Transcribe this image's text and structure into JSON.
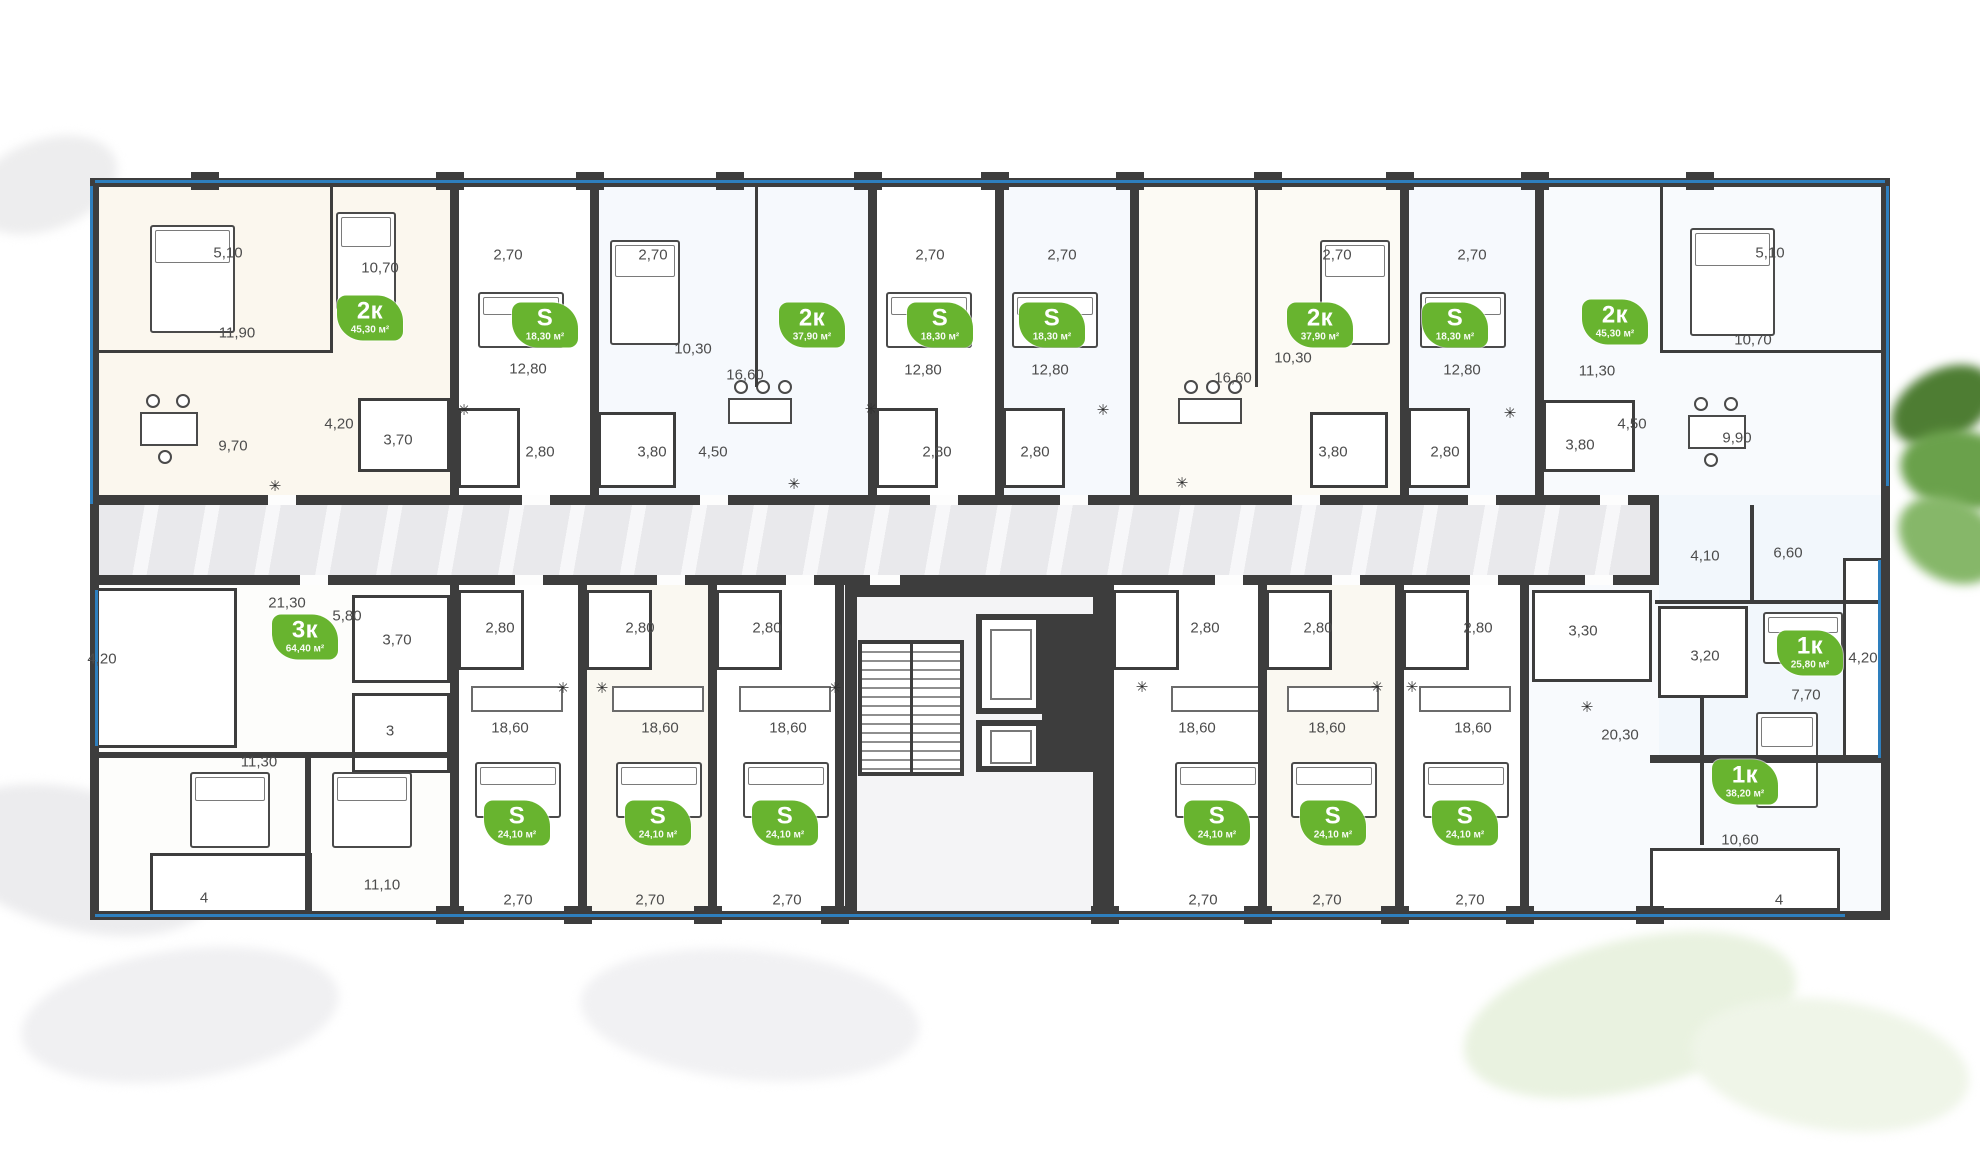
{
  "meta": {
    "description": "Residential building floor plan with apartment type badges and room dimensions"
  },
  "colors": {
    "badge_green": "#68b42f",
    "wall_dark": "#3d3d3d",
    "glazing_blue": "#2e7fbe",
    "corridor_gray": "#eaeaec",
    "dimension_text": "#4c4c4c"
  },
  "icons": {
    "appliance_glyph": "✳"
  },
  "apartments": [
    {
      "type": "2к",
      "area": "45,30 м²",
      "x": 370,
      "y": 318
    },
    {
      "type": "S",
      "area": "18,30 м²",
      "x": 545,
      "y": 325
    },
    {
      "type": "2к",
      "area": "37,90 м²",
      "x": 812,
      "y": 325
    },
    {
      "type": "S",
      "area": "18,30 м²",
      "x": 940,
      "y": 325
    },
    {
      "type": "S",
      "area": "18,30 м²",
      "x": 1052,
      "y": 325
    },
    {
      "type": "2к",
      "area": "37,90 м²",
      "x": 1320,
      "y": 325
    },
    {
      "type": "S",
      "area": "18,30 м²",
      "x": 1455,
      "y": 325
    },
    {
      "type": "2к",
      "area": "45,30 м²",
      "x": 1615,
      "y": 322
    },
    {
      "type": "3к",
      "area": "64,40 м²",
      "x": 305,
      "y": 637
    },
    {
      "type": "S",
      "area": "24,10 м²",
      "x": 517,
      "y": 823
    },
    {
      "type": "S",
      "area": "24,10 м²",
      "x": 658,
      "y": 823
    },
    {
      "type": "S",
      "area": "24,10 м²",
      "x": 785,
      "y": 823
    },
    {
      "type": "S",
      "area": "24,10 м²",
      "x": 1217,
      "y": 823
    },
    {
      "type": "S",
      "area": "24,10 м²",
      "x": 1333,
      "y": 823
    },
    {
      "type": "S",
      "area": "24,10 м²",
      "x": 1465,
      "y": 823
    },
    {
      "type": "1к",
      "area": "25,80 м²",
      "x": 1810,
      "y": 653
    },
    {
      "type": "1к",
      "area": "38,20 м²",
      "x": 1745,
      "y": 782
    }
  ],
  "dimensions": [
    {
      "t": "5,10",
      "x": 228,
      "y": 253
    },
    {
      "t": "10,70",
      "x": 380,
      "y": 268
    },
    {
      "t": "2,70",
      "x": 508,
      "y": 255
    },
    {
      "t": "2,70",
      "x": 653,
      "y": 255
    },
    {
      "t": "2,70",
      "x": 930,
      "y": 255
    },
    {
      "t": "2,70",
      "x": 1062,
      "y": 255
    },
    {
      "t": "2,70",
      "x": 1337,
      "y": 255
    },
    {
      "t": "2,70",
      "x": 1472,
      "y": 255
    },
    {
      "t": "5,10",
      "x": 1770,
      "y": 253
    },
    {
      "t": "10,70",
      "x": 1753,
      "y": 340
    },
    {
      "t": "11,90",
      "x": 237,
      "y": 333
    },
    {
      "t": "12,80",
      "x": 528,
      "y": 369
    },
    {
      "t": "10,30",
      "x": 693,
      "y": 349
    },
    {
      "t": "16,60",
      "x": 745,
      "y": 375
    },
    {
      "t": "12,80",
      "x": 923,
      "y": 370
    },
    {
      "t": "12,80",
      "x": 1050,
      "y": 370
    },
    {
      "t": "16,60",
      "x": 1233,
      "y": 378
    },
    {
      "t": "10,30",
      "x": 1293,
      "y": 358
    },
    {
      "t": "12,80",
      "x": 1462,
      "y": 370
    },
    {
      "t": "11,30",
      "x": 1597,
      "y": 371
    },
    {
      "t": "4,20",
      "x": 339,
      "y": 424
    },
    {
      "t": "3,70",
      "x": 398,
      "y": 440
    },
    {
      "t": "9,70",
      "x": 233,
      "y": 446
    },
    {
      "t": "2,80",
      "x": 540,
      "y": 452
    },
    {
      "t": "3,80",
      "x": 652,
      "y": 452
    },
    {
      "t": "4,50",
      "x": 713,
      "y": 452
    },
    {
      "t": "2,80",
      "x": 937,
      "y": 452
    },
    {
      "t": "2,80",
      "x": 1035,
      "y": 452
    },
    {
      "t": "3,80",
      "x": 1333,
      "y": 452
    },
    {
      "t": "2,80",
      "x": 1445,
      "y": 452
    },
    {
      "t": "3,80",
      "x": 1580,
      "y": 445
    },
    {
      "t": "4,50",
      "x": 1632,
      "y": 424
    },
    {
      "t": "9,90",
      "x": 1737,
      "y": 438
    },
    {
      "t": "4,10",
      "x": 1705,
      "y": 556
    },
    {
      "t": "6,60",
      "x": 1788,
      "y": 553
    },
    {
      "t": "3,20",
      "x": 1705,
      "y": 656
    },
    {
      "t": "7,70",
      "x": 1806,
      "y": 695
    },
    {
      "t": "4,20",
      "x": 1863,
      "y": 658
    },
    {
      "t": "21,30",
      "x": 287,
      "y": 603
    },
    {
      "t": "5,80",
      "x": 347,
      "y": 616
    },
    {
      "t": "4,20",
      "x": 102,
      "y": 659
    },
    {
      "t": "3,70",
      "x": 397,
      "y": 640
    },
    {
      "t": "11,30",
      "x": 259,
      "y": 762
    },
    {
      "t": "11,10",
      "x": 382,
      "y": 885
    },
    {
      "t": "2,80",
      "x": 500,
      "y": 628
    },
    {
      "t": "2,80",
      "x": 640,
      "y": 628
    },
    {
      "t": "2,80",
      "x": 767,
      "y": 628
    },
    {
      "t": "2,80",
      "x": 1205,
      "y": 628
    },
    {
      "t": "2,80",
      "x": 1318,
      "y": 628
    },
    {
      "t": "2,80",
      "x": 1478,
      "y": 628
    },
    {
      "t": "3,30",
      "x": 1583,
      "y": 631
    },
    {
      "t": "18,60",
      "x": 510,
      "y": 728
    },
    {
      "t": "18,60",
      "x": 660,
      "y": 728
    },
    {
      "t": "18,60",
      "x": 788,
      "y": 728
    },
    {
      "t": "18,60",
      "x": 1197,
      "y": 728
    },
    {
      "t": "18,60",
      "x": 1327,
      "y": 728
    },
    {
      "t": "18,60",
      "x": 1473,
      "y": 728
    },
    {
      "t": "20,30",
      "x": 1620,
      "y": 735
    },
    {
      "t": "10,60",
      "x": 1740,
      "y": 840
    },
    {
      "t": "2,70",
      "x": 518,
      "y": 900
    },
    {
      "t": "2,70",
      "x": 650,
      "y": 900
    },
    {
      "t": "2,70",
      "x": 787,
      "y": 900
    },
    {
      "t": "2,70",
      "x": 1203,
      "y": 900
    },
    {
      "t": "2,70",
      "x": 1327,
      "y": 900
    },
    {
      "t": "2,70",
      "x": 1470,
      "y": 900
    }
  ],
  "room_numbers": [
    {
      "t": "3",
      "x": 390,
      "y": 731
    },
    {
      "t": "4",
      "x": 204,
      "y": 898
    },
    {
      "t": "4",
      "x": 1779,
      "y": 900
    }
  ],
  "appliances": [
    {
      "x": 275,
      "y": 486
    },
    {
      "x": 464,
      "y": 410
    },
    {
      "x": 794,
      "y": 484
    },
    {
      "x": 871,
      "y": 409
    },
    {
      "x": 1103,
      "y": 410
    },
    {
      "x": 1182,
      "y": 483
    },
    {
      "x": 1510,
      "y": 413
    },
    {
      "x": 563,
      "y": 688
    },
    {
      "x": 602,
      "y": 688
    },
    {
      "x": 835,
      "y": 688
    },
    {
      "x": 1142,
      "y": 687
    },
    {
      "x": 1377,
      "y": 687
    },
    {
      "x": 1412,
      "y": 687
    },
    {
      "x": 1587,
      "y": 707
    }
  ]
}
